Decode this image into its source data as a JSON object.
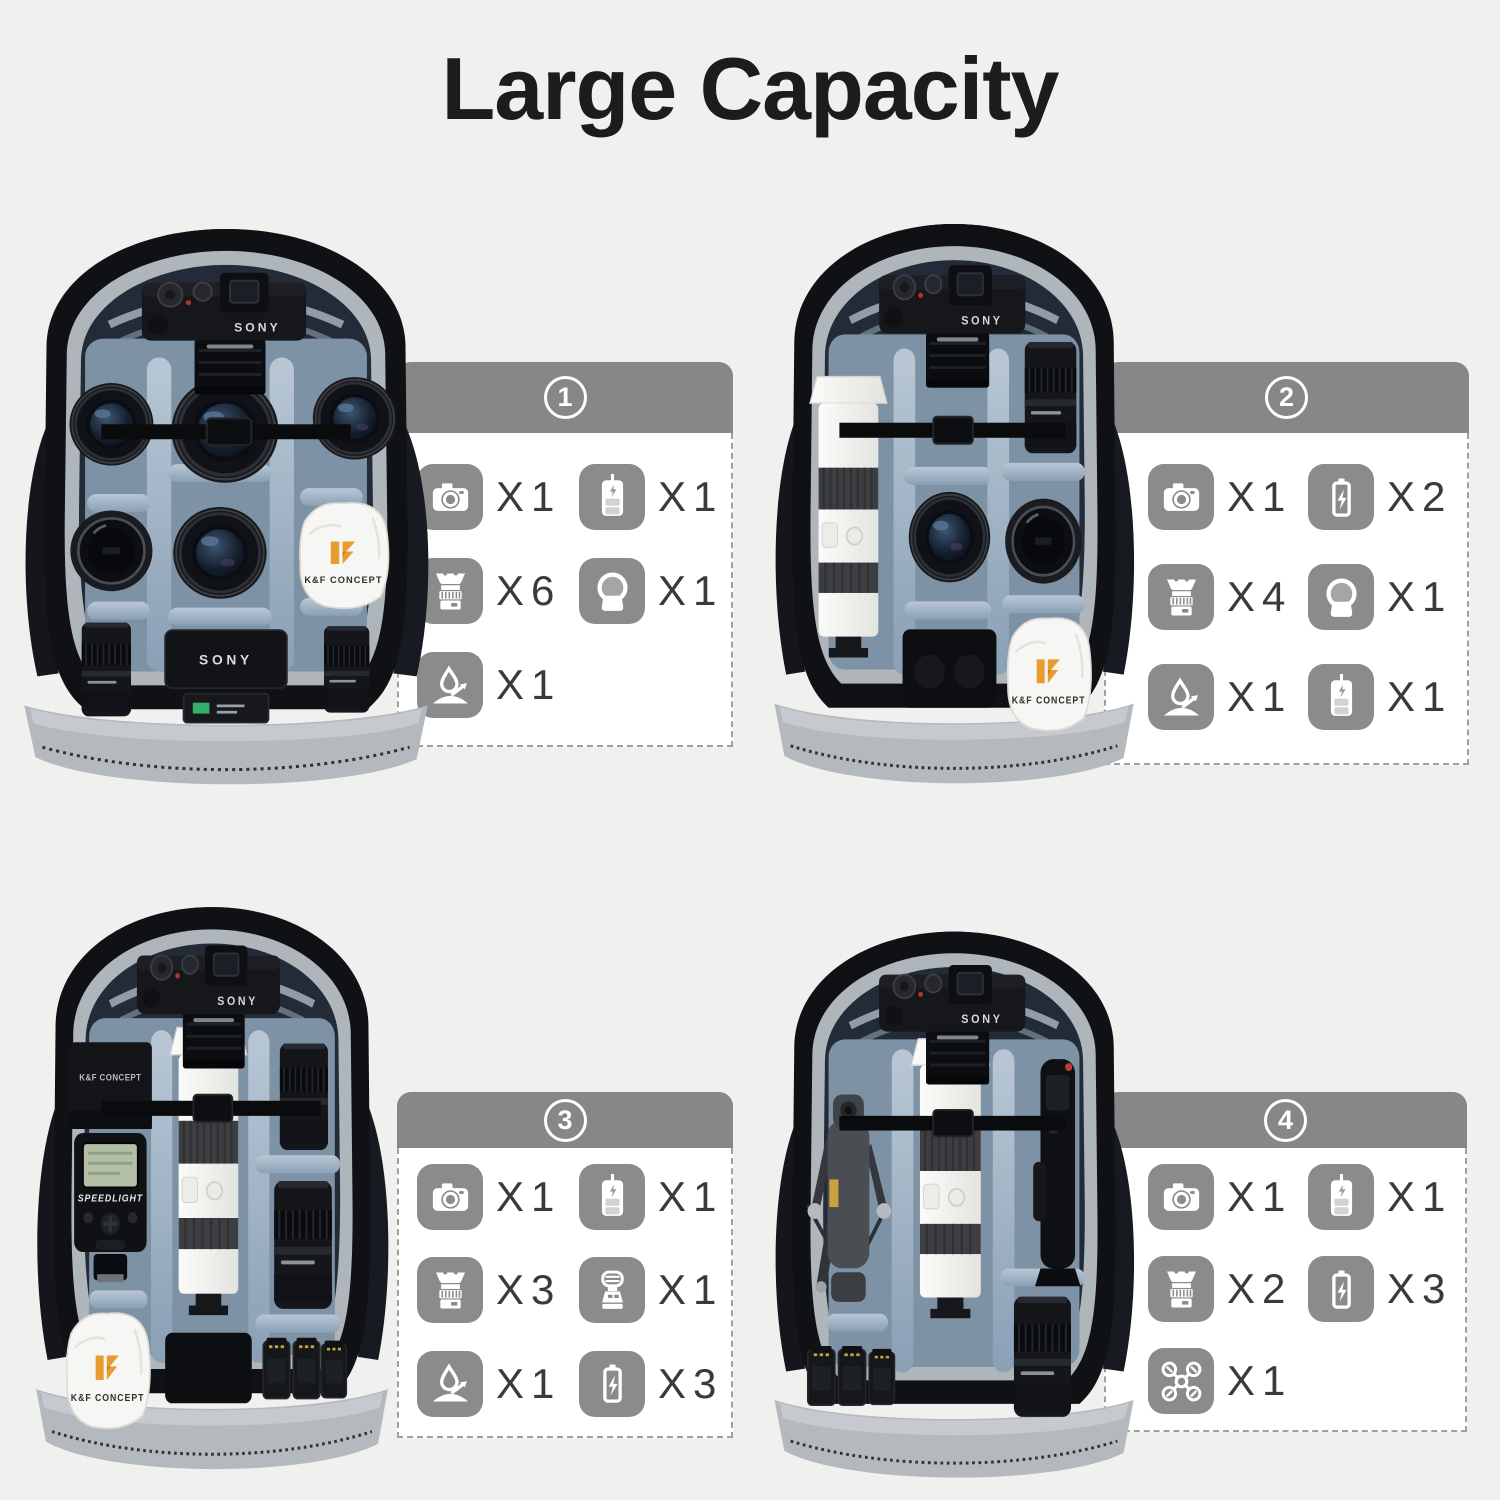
{
  "page": {
    "title": "Large Capacity",
    "background": "#f0f0ef"
  },
  "colors": {
    "header_gray": "#878787",
    "icon_gray": "#8b8b8b",
    "qty_text": "#3a3a3a",
    "card_border": "#a0a0a0",
    "brand_orange": "#e89b2e"
  },
  "panels": [
    {
      "badge": "1",
      "items": [
        {
          "icon": "camera",
          "label": "X1"
        },
        {
          "icon": "battery-charger",
          "label": "X1"
        },
        {
          "icon": "lens",
          "label": "X6"
        },
        {
          "icon": "filter",
          "label": "X1"
        },
        {
          "icon": "waterproof",
          "label": "X1"
        }
      ]
    },
    {
      "badge": "2",
      "items": [
        {
          "icon": "camera",
          "label": "X1"
        },
        {
          "icon": "battery",
          "label": "X2"
        },
        {
          "icon": "lens",
          "label": "X4"
        },
        {
          "icon": "filter",
          "label": "X1"
        },
        {
          "icon": "waterproof",
          "label": "X1"
        },
        {
          "icon": "battery-charger",
          "label": "X1"
        }
      ]
    },
    {
      "badge": "3",
      "items": [
        {
          "icon": "camera",
          "label": "X1"
        },
        {
          "icon": "battery-charger",
          "label": "X1"
        },
        {
          "icon": "lens",
          "label": "X3"
        },
        {
          "icon": "flash",
          "label": "X1"
        },
        {
          "icon": "waterproof",
          "label": "X1"
        },
        {
          "icon": "battery",
          "label": "X3"
        }
      ]
    },
    {
      "badge": "4",
      "items": [
        {
          "icon": "camera",
          "label": "X1"
        },
        {
          "icon": "battery-charger",
          "label": "X1"
        },
        {
          "icon": "lens",
          "label": "X2"
        },
        {
          "icon": "battery",
          "label": "X3"
        },
        {
          "icon": "drone",
          "label": "X1"
        }
      ]
    }
  ],
  "photo_labels": {
    "camera_brand": "SONY",
    "kf_brand": "K&F CONCEPT",
    "flash_label": "SPEEDLIGHT",
    "charger_brand": "SONY"
  }
}
